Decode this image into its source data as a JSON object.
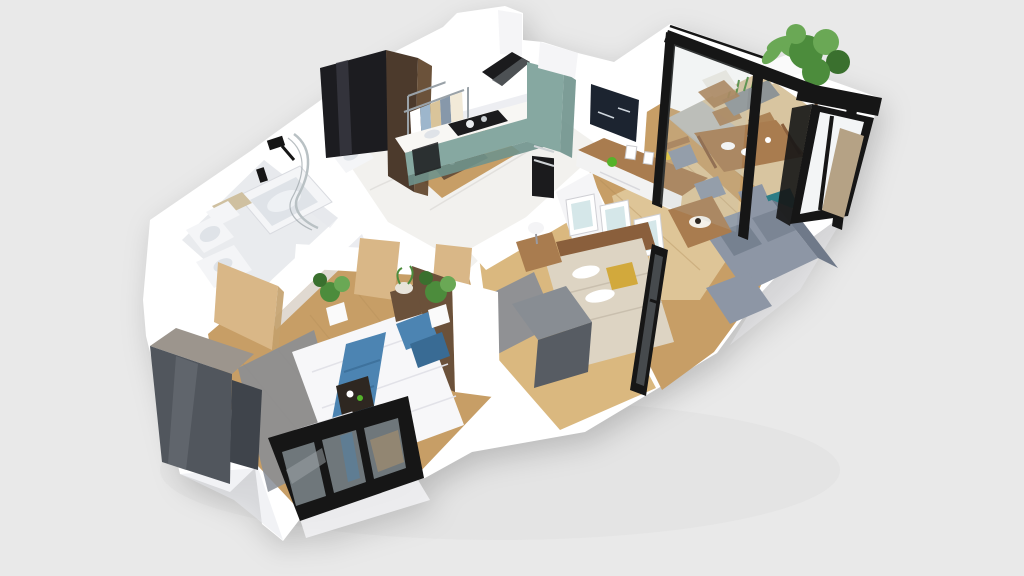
{
  "scene": {
    "type": "3d-floorplan-render",
    "description": "Photorealistic 3D dollhouse floor plan of a two-bedroom apartment seen from above at a diagonal angle on a plain light-gray backdrop. No text, labels or UI controls are visible in the image.",
    "view": "perspective top-down, apartment long axis running lower-left to upper-right",
    "palette": {
      "background": "#e9e9e9",
      "backdrop_shadow": "#dcdcde",
      "wall_white": "#ffffff",
      "wall_light": "#f5f5f7",
      "wall_shade": "#e6e7ec",
      "wall_dark": "#d7d8de",
      "floor_marble": "#f2f1ee",
      "marble_vein": "#dddcd8",
      "floor_wood": "#c79e66",
      "floor_wood_light": "#dab87f",
      "plank_line": "#b08a55",
      "floor_tile": "#e9ebee",
      "deck_wood": "#d8c5a0",
      "deck_tile": "#b7bcbd",
      "rug_beige": "#e6d2a8",
      "rug_gray": "#878d97",
      "rug_gray_dark": "#6e747e",
      "frame_black": "#161616",
      "glass_gray": "#6f777b",
      "glass_light": "#b9c1c4",
      "glass_streak": "#9aa3a6",
      "cabinet_teal": "#86a8a1",
      "cabinet_teal_dark": "#6f928c",
      "counter_white": "#f8f7f4",
      "appliance_black": "#1b1b1d",
      "wardrobe_black": "#1c1c20",
      "wardrobe_black_hi": "#3a3a42",
      "wardrobe_brown": "#4c3a2c",
      "wardrobe_brown_side": "#63492f",
      "wardrobe_gray": "#51565d",
      "wardrobe_gray_hi": "#6b7077",
      "wardrobe_gray_top": "#9c958d",
      "dresser_gray": "#888d93",
      "dresser_gray_dark": "#575c63",
      "sofa_gray": "#8d96a5",
      "sofa_gray_dark": "#6f7989",
      "wood_furniture": "#a97c4f",
      "wood_dark": "#8a5f3c",
      "bed_white": "#f7f7f9",
      "bed_fold": "#e2e2e8",
      "bed_beige": "#ddd4c3",
      "bed_blue": "#4c84b2",
      "bed_blue_dark": "#396b94",
      "pillow_mustard": "#d2a93c",
      "plant_green": "#4c8c3c",
      "plant_green_light": "#6aa855",
      "plant_green_dark": "#3a702e",
      "pot_white": "#fafafa",
      "pot_brown": "#6b513a",
      "tv_black": "#1c2430",
      "door_wood": "#d9b787",
      "door_wood_dark": "#c3a06c",
      "art_blue": "#d5e7e9",
      "accent_green": "#55b32a",
      "accent_yellow": "#e4c531",
      "tray_dark": "#2e2721",
      "metal_gray": "#9aa2a8",
      "fixture_white": "#f4f5f7",
      "fixture_shade": "#dfe3e8"
    },
    "rooms": [
      {
        "name": "kitchen",
        "contents": [
          "white-upper-cabinets",
          "black-range-hood",
          "teal-base-cabinets",
          "marble-countertop",
          "black-cooktop",
          "tall-teal-oven-cabinet",
          "built-in-black-oven",
          "marble-floor"
        ]
      },
      {
        "name": "hallway",
        "contents": [
          "black-gloss-wardrobe",
          "walnut-wardrobe",
          "open-clothes-rack",
          "hanging-clothes",
          "shoe-shelf",
          "wood-floor"
        ]
      },
      {
        "name": "bathroom",
        "contents": [
          "bathtub",
          "toilet",
          "vanity-sink",
          "curved-glass-shower-screen",
          "black-wall-shower-head",
          "second-sink",
          "light-oak-door",
          "tile-floor"
        ]
      },
      {
        "name": "living-dining-room",
        "contents": [
          "wall-mounted-tv",
          "walnut-tv-console",
          "decor-objects",
          "wood-dining-table",
          "tableware",
          "dining-chairs",
          "teal-accent-chair",
          "l-shaped-gray-sofa",
          "wood-coffee-table",
          "beige-area-rug",
          "wood-floor"
        ]
      },
      {
        "name": "balcony",
        "contents": [
          "black-glass-partition",
          "white-parapet",
          "gray-grass-planter",
          "white-palm-planter",
          "tall-green-tree",
          "wood-armchair",
          "tilted-black-window-frames",
          "deck-floor"
        ]
      },
      {
        "name": "bedroom-small",
        "contents": [
          "beige-double-bed",
          "wood-headboard",
          "white-bolster-pillows",
          "mustard-pillow",
          "nightstand",
          "white-table-lamp",
          "three-framed-art-prints",
          "gray-dresser",
          "black-glass-partition",
          "speckled-gray-rug"
        ]
      },
      {
        "name": "bedroom-master",
        "contents": [
          "white-double-bed",
          "patterned-blue-runner",
          "blue-pillows",
          "dark-breakfast-tray",
          "white-foot-bench",
          "gray-rug",
          "glossy-gray-wardrobe",
          "brown-headboard-wall-panel",
          "light-oak-doors",
          "potted-plants",
          "tilted-black-window"
        ]
      }
    ]
  }
}
